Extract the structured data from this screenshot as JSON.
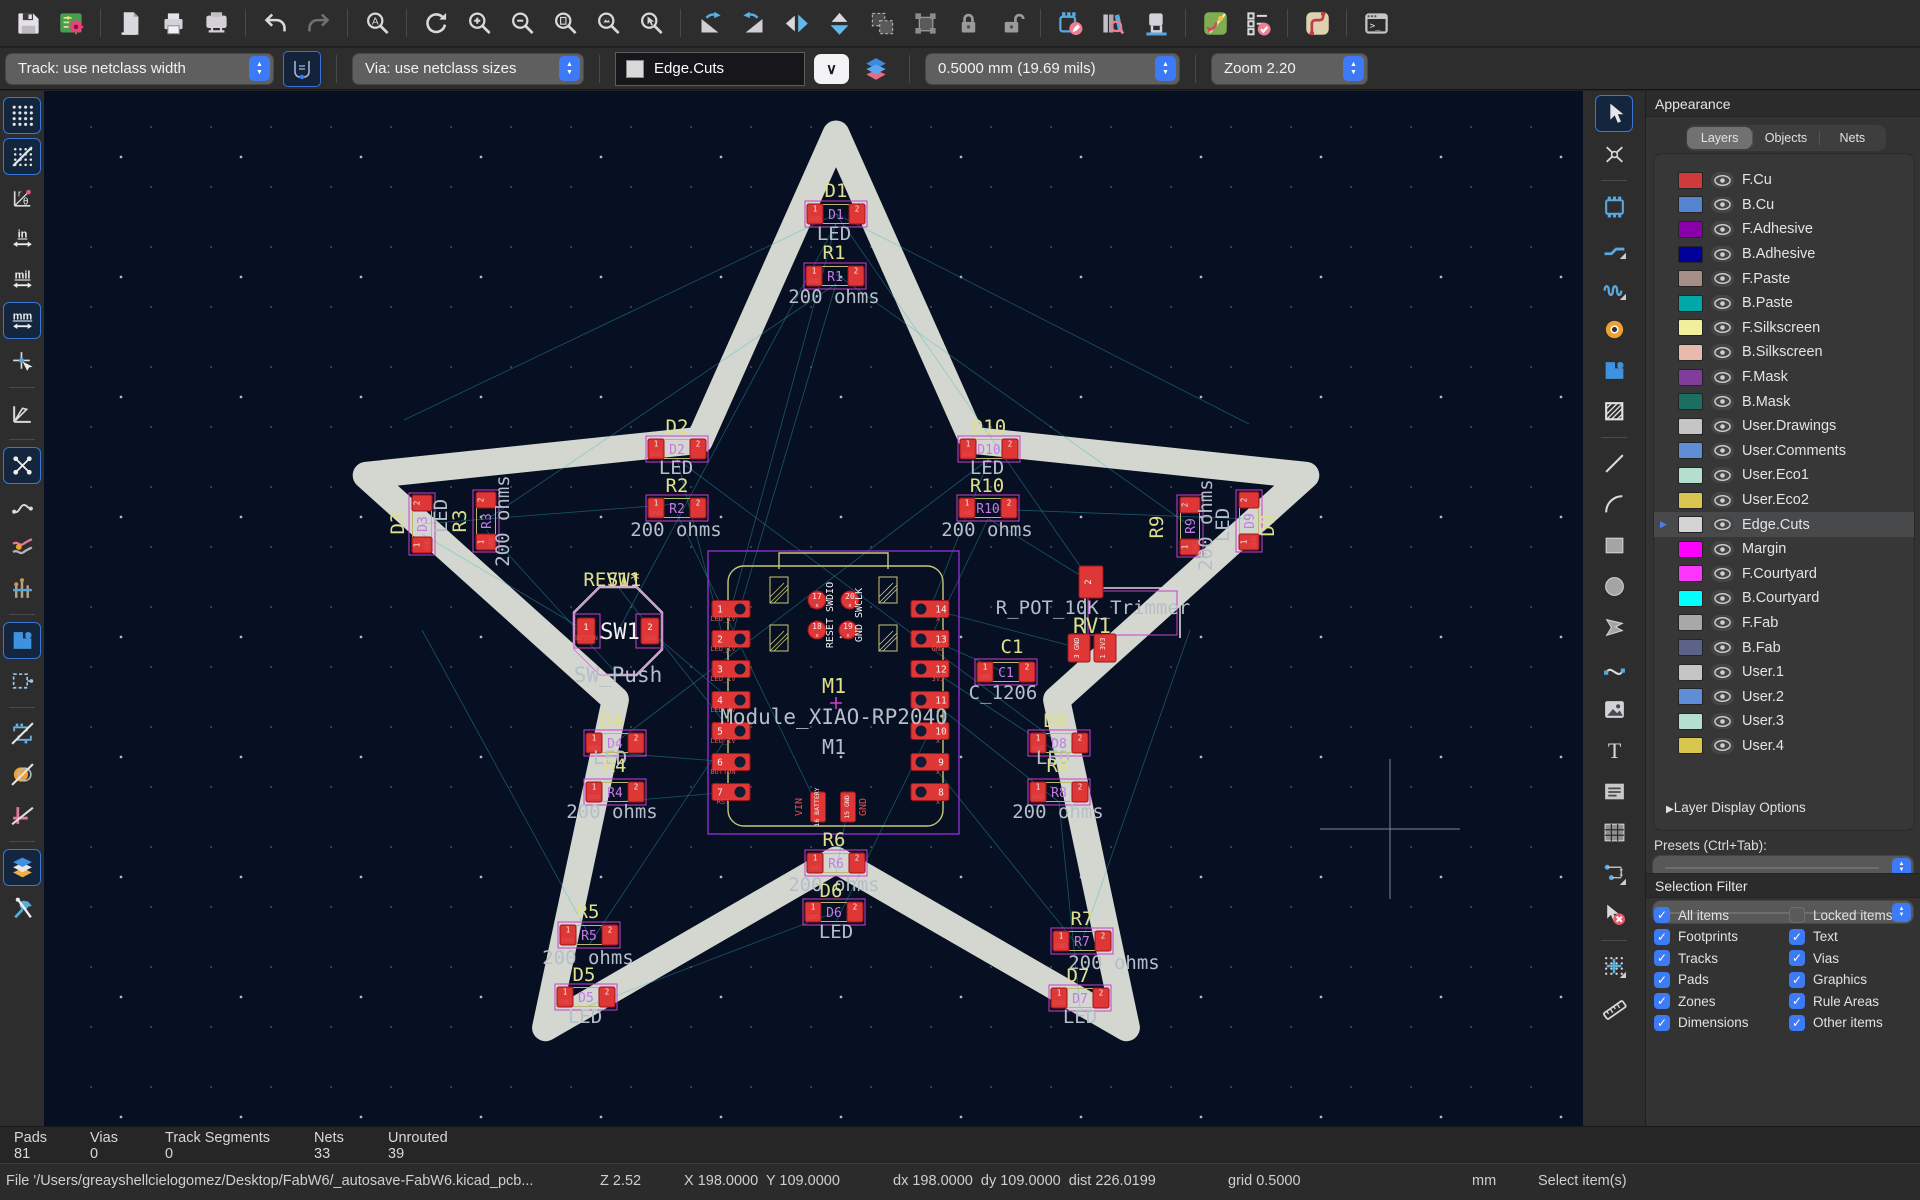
{
  "toolbar_top": {
    "items": [
      {
        "n": "save"
      },
      {
        "n": "board-setup"
      },
      {
        "n": "sep"
      },
      {
        "n": "page-settings"
      },
      {
        "n": "print"
      },
      {
        "n": "plot"
      },
      {
        "n": "sep"
      },
      {
        "n": "undo"
      },
      {
        "n": "redo"
      },
      {
        "n": "sep"
      },
      {
        "n": "find"
      },
      {
        "n": "sep"
      },
      {
        "n": "refresh"
      },
      {
        "n": "zoom-in"
      },
      {
        "n": "zoom-out"
      },
      {
        "n": "zoom-fit-page"
      },
      {
        "n": "zoom-fit-objects"
      },
      {
        "n": "zoom-selection"
      },
      {
        "n": "sep"
      },
      {
        "n": "rotate-ccw"
      },
      {
        "n": "rotate-cw"
      },
      {
        "n": "flip-horizontal"
      },
      {
        "n": "flip-vertical"
      },
      {
        "n": "group"
      },
      {
        "n": "ungroup"
      },
      {
        "n": "lock"
      },
      {
        "n": "unlock"
      },
      {
        "n": "sep"
      },
      {
        "n": "footprint-editor"
      },
      {
        "n": "footprint-browser"
      },
      {
        "n": "threed-viewer"
      },
      {
        "n": "sep"
      },
      {
        "n": "update-pcb"
      },
      {
        "n": "drc"
      },
      {
        "n": "sep"
      },
      {
        "n": "net-inspector"
      },
      {
        "n": "sep"
      },
      {
        "n": "python-console"
      }
    ]
  },
  "toolbar_settings": {
    "track_combo": "Track: use netclass width",
    "via_combo": "Via: use netclass sizes",
    "layer_combo": "Edge.Cuts",
    "grid_combo": "0.5000 mm (19.69 mils)",
    "zoom_combo": "Zoom 2.20",
    "dropdown_chevron": "∨"
  },
  "left_toolbar": {
    "items": [
      {
        "n": "grid-visibility",
        "active": true
      },
      {
        "n": "grid-override",
        "active": true
      },
      {
        "n": "polar-coords"
      },
      {
        "n": "units-inches"
      },
      {
        "n": "units-mils"
      },
      {
        "n": "units-mm",
        "active": true
      },
      {
        "n": "cursor-shape"
      },
      {
        "n": "sep"
      },
      {
        "n": "constrain-45"
      },
      {
        "n": "sep"
      },
      {
        "n": "show-ratsnest",
        "active": true
      },
      {
        "n": "curved-ratsnest"
      },
      {
        "n": "highlight-nets"
      },
      {
        "n": "net-colors"
      },
      {
        "n": "sep"
      },
      {
        "n": "zone-filled",
        "active": true
      },
      {
        "n": "zone-outline"
      },
      {
        "n": "sep"
      },
      {
        "n": "sketch-footprints"
      },
      {
        "n": "sketch-pads"
      },
      {
        "n": "sketch-tracks"
      },
      {
        "n": "sep"
      },
      {
        "n": "high-contrast",
        "active": true
      },
      {
        "n": "properties-tools"
      }
    ]
  },
  "right_toolbar": {
    "items": [
      {
        "n": "select",
        "active": true
      },
      {
        "n": "local-ratsnest"
      },
      {
        "n": "sep"
      },
      {
        "n": "place-footprint"
      },
      {
        "n": "route-tracks"
      },
      {
        "n": "tune-length"
      },
      {
        "n": "place-via"
      },
      {
        "n": "draw-zone"
      },
      {
        "n": "rule-area"
      },
      {
        "n": "sep"
      },
      {
        "n": "draw-line"
      },
      {
        "n": "draw-arc"
      },
      {
        "n": "draw-rectangle"
      },
      {
        "n": "draw-circle"
      },
      {
        "n": "draw-polygon"
      },
      {
        "n": "draw-bezier"
      },
      {
        "n": "place-image"
      },
      {
        "n": "place-text"
      },
      {
        "n": "place-textbox"
      },
      {
        "n": "place-table"
      },
      {
        "n": "dimension"
      },
      {
        "n": "delete-tool"
      },
      {
        "n": "sep"
      },
      {
        "n": "grid-origin"
      },
      {
        "n": "measure"
      }
    ]
  },
  "appearance": {
    "title": "Appearance",
    "tabs": [
      "Layers",
      "Objects",
      "Nets"
    ],
    "active_tab": "Layers",
    "layers": [
      {
        "name": "F.Cu",
        "color": "#d03a3a"
      },
      {
        "name": "B.Cu",
        "color": "#5585d0"
      },
      {
        "name": "F.Adhesive",
        "color": "#8a00a8"
      },
      {
        "name": "B.Adhesive",
        "color": "#00009b"
      },
      {
        "name": "F.Paste",
        "color": "#a58d88"
      },
      {
        "name": "B.Paste",
        "color": "#00a8a8"
      },
      {
        "name": "F.Silkscreen",
        "color": "#f2ef9c"
      },
      {
        "name": "B.Silkscreen",
        "color": "#e9b9ad"
      },
      {
        "name": "F.Mask",
        "color": "#803d9b"
      },
      {
        "name": "B.Mask",
        "color": "#1d6e62"
      },
      {
        "name": "User.Drawings",
        "color": "#c5c5c5"
      },
      {
        "name": "User.Comments",
        "color": "#5f8ed6"
      },
      {
        "name": "User.Eco1",
        "color": "#b5decf"
      },
      {
        "name": "User.Eco2",
        "color": "#d9c64e"
      },
      {
        "name": "Edge.Cuts",
        "color": "#d4d4d4",
        "selected": true
      },
      {
        "name": "Margin",
        "color": "#ff00ff"
      },
      {
        "name": "F.Courtyard",
        "color": "#fc36fc"
      },
      {
        "name": "B.Courtyard",
        "color": "#00ffff"
      },
      {
        "name": "F.Fab",
        "color": "#a8a8a8"
      },
      {
        "name": "B.Fab",
        "color": "#5c6387"
      },
      {
        "name": "User.1",
        "color": "#c5c5c5"
      },
      {
        "name": "User.2",
        "color": "#5f8ed6"
      },
      {
        "name": "User.3",
        "color": "#b5decf"
      },
      {
        "name": "User.4",
        "color": "#d9c64e"
      }
    ],
    "layer_display_options": "Layer Display Options",
    "presets_label": "Presets (Ctrl+Tab):",
    "viewports_label": "Viewports (Option+Tab):"
  },
  "selection_filter": {
    "title": "Selection Filter",
    "items": [
      {
        "label": "All items",
        "checked": true
      },
      {
        "label": "Locked items",
        "checked": false
      },
      {
        "label": "Footprints",
        "checked": true
      },
      {
        "label": "Text",
        "checked": true
      },
      {
        "label": "Tracks",
        "checked": true
      },
      {
        "label": "Vias",
        "checked": true
      },
      {
        "label": "Pads",
        "checked": true
      },
      {
        "label": "Graphics",
        "checked": true
      },
      {
        "label": "Zones",
        "checked": true
      },
      {
        "label": "Rule Areas",
        "checked": true
      },
      {
        "label": "Dimensions",
        "checked": true
      },
      {
        "label": "Other items",
        "checked": true
      }
    ]
  },
  "stats": {
    "pads_label": "Pads",
    "pads": "81",
    "vias_label": "Vias",
    "vias": "0",
    "track_segments_label": "Track Segments",
    "track_segments": "0",
    "nets_label": "Nets",
    "nets": "33",
    "unrouted_label": "Unrouted",
    "unrouted": "39"
  },
  "status_bar": {
    "file": "File '/Users/greayshellcielogomez/Desktop/FabW6/_autosave-FabW6.kicad_pcb...",
    "zoom": "Z 2.52",
    "xy": "X 198.0000  Y 109.0000",
    "dxdy": "dx 198.0000  dy 109.0000  dist 226.0199",
    "grid": "grid 0.5000",
    "units": "mm",
    "mode": "Select item(s)"
  },
  "pcb": {
    "star": {
      "cx": 836,
      "cy": 628,
      "outer_r": 494,
      "inner_r": 232,
      "stroke": "#d3d7cf",
      "width": 27
    },
    "cursor_cross": {
      "x": 1390,
      "y": 829
    },
    "footprints": [
      {
        "ref": "D1",
        "x": 836,
        "y": 214
      },
      {
        "ref": "R1",
        "x": 835,
        "y": 276
      },
      {
        "ref": "D2",
        "x": 677,
        "y": 449
      },
      {
        "ref": "R2",
        "x": 677,
        "y": 508
      },
      {
        "ref": "D10",
        "x": 989,
        "y": 449
      },
      {
        "ref": "R10",
        "x": 988,
        "y": 508
      },
      {
        "ref": "D3",
        "x": 422,
        "y": 524,
        "vert": true
      },
      {
        "ref": "R3",
        "x": 486,
        "y": 521,
        "vert": true
      },
      {
        "ref": "R9",
        "x": 1190,
        "y": 526,
        "vert": true
      },
      {
        "ref": "D9",
        "x": 1249,
        "y": 521,
        "vert": true
      },
      {
        "ref": "D4",
        "x": 615,
        "y": 743
      },
      {
        "ref": "R4",
        "x": 615,
        "y": 792
      },
      {
        "ref": "D8",
        "x": 1059,
        "y": 743
      },
      {
        "ref": "R8",
        "x": 1059,
        "y": 792
      },
      {
        "ref": "R6",
        "x": 836,
        "y": 863
      },
      {
        "ref": "D6",
        "x": 834,
        "y": 912
      },
      {
        "ref": "R5",
        "x": 589,
        "y": 935
      },
      {
        "ref": "D5",
        "x": 586,
        "y": 997
      },
      {
        "ref": "R7",
        "x": 1082,
        "y": 941
      },
      {
        "ref": "D7",
        "x": 1080,
        "y": 998
      },
      {
        "ref": "C1",
        "x": 1006,
        "y": 672
      }
    ],
    "texts": [
      [
        836,
        197,
        "D1",
        "y"
      ],
      [
        834,
        240,
        "LED",
        "g"
      ],
      [
        834,
        259,
        "R1",
        "y"
      ],
      [
        834,
        303,
        "200 ohms",
        "g"
      ],
      [
        677,
        433,
        "D2",
        "y"
      ],
      [
        676,
        474,
        "LED",
        "g"
      ],
      [
        677,
        492,
        "R2",
        "y"
      ],
      [
        676,
        536,
        "200 ohms",
        "g"
      ],
      [
        989,
        433,
        "D10",
        "y"
      ],
      [
        987,
        474,
        "LED",
        "g"
      ],
      [
        987,
        492,
        "R10",
        "y"
      ],
      [
        987,
        536,
        "200 ohms",
        "g"
      ],
      [
        404,
        523,
        "D3",
        "y",
        -90
      ],
      [
        447,
        516,
        "LED",
        "g",
        -90
      ],
      [
        466,
        521,
        "R3",
        "y",
        -90
      ],
      [
        509,
        521,
        "200 ohms",
        "g",
        -90
      ],
      [
        1163,
        527,
        "R9",
        "y",
        -90
      ],
      [
        1212,
        525,
        "200 ohms",
        "g",
        -90
      ],
      [
        1229,
        525,
        "LED",
        "g",
        -90
      ],
      [
        1274,
        525,
        "D9",
        "y",
        -90
      ],
      [
        612,
        586,
        "REV1*",
        "y"
      ],
      [
        624,
        586,
        "SW1",
        "y"
      ],
      [
        620,
        639,
        "SW1",
        "w",
        0,
        22
      ],
      [
        618,
        682,
        "SW_Push",
        "g",
        0,
        21
      ],
      [
        1093,
        614,
        "R_POT_10K_Trimmer",
        "g"
      ],
      [
        1092,
        633,
        "RV1",
        "y",
        0,
        21
      ],
      [
        1012,
        653,
        "C1",
        "y"
      ],
      [
        1003,
        699,
        "C_1206",
        "g"
      ],
      [
        612,
        727,
        "D4",
        "y"
      ],
      [
        610,
        764,
        "LED",
        "g"
      ],
      [
        615,
        772,
        "R4",
        "y"
      ],
      [
        612,
        818,
        "200 ohms",
        "g"
      ],
      [
        1055,
        727,
        "D8",
        "y"
      ],
      [
        1053,
        764,
        "LED",
        "g"
      ],
      [
        1058,
        772,
        "R8",
        "y"
      ],
      [
        1058,
        818,
        "200 ohms",
        "g"
      ],
      [
        834,
        846,
        "R6",
        "y"
      ],
      [
        834,
        891,
        "200 ohms",
        "g"
      ],
      [
        831,
        897,
        "D6",
        "y"
      ],
      [
        836,
        938,
        "LED",
        "g"
      ],
      [
        588,
        918,
        "R5",
        "y"
      ],
      [
        588,
        964,
        "200 ohms",
        "g"
      ],
      [
        584,
        981,
        "D5",
        "y"
      ],
      [
        585,
        1023,
        "LED",
        "g"
      ],
      [
        1082,
        925,
        "R7",
        "y"
      ],
      [
        1114,
        969,
        "200 ohms",
        "g"
      ],
      [
        1078,
        982,
        "D7",
        "y"
      ],
      [
        1080,
        1023,
        "LED",
        "g"
      ],
      [
        834,
        693,
        "M1",
        "y",
        0,
        20
      ],
      [
        834,
        724,
        "Module_XIAO-RP2040",
        "g",
        0,
        21
      ],
      [
        834,
        754,
        "M1",
        "g",
        0,
        20
      ]
    ],
    "module": {
      "frame": [
        708,
        551,
        251,
        283
      ],
      "body": [
        728,
        566,
        215,
        260
      ],
      "usb": [
        779,
        553,
        109,
        16
      ],
      "hatch": [
        [
          770,
          577
        ],
        [
          879,
          577
        ],
        [
          770,
          625
        ],
        [
          879,
          625
        ]
      ],
      "pin_y": [
        609,
        639,
        669,
        700,
        731,
        762,
        792
      ],
      "left_x": 731,
      "right_x": 930,
      "left_pins": [
        "1",
        "2",
        "3",
        "4",
        "5",
        "6",
        "7"
      ],
      "left_labels": [
        "LED_1V",
        "LED_1V",
        "LED_1V",
        "LED_1V",
        "LED_1V",
        "BUTTON",
        "RST"
      ],
      "right_pins": [
        "14",
        "13",
        "12",
        "11",
        "10",
        "9",
        "8"
      ],
      "right_labels": [
        "x",
        "GND",
        "3V3",
        "x",
        "x",
        "x",
        "x"
      ],
      "top_pins": [
        {
          "n": "17",
          "x": 817,
          "y": 600
        },
        {
          "n": "20",
          "x": 850,
          "y": 600
        },
        {
          "n": "18",
          "x": 817,
          "y": 630
        },
        {
          "n": "19",
          "x": 848,
          "y": 630
        }
      ],
      "top_labels": [
        {
          "x": 833,
          "y": 615,
          "s": "RESET SWDIO"
        },
        {
          "x": 862,
          "y": 615,
          "s": "GND SWCLK"
        }
      ],
      "bottom_pads": [
        {
          "x": 818,
          "y": 807,
          "s": "16 BATTERY"
        },
        {
          "x": 848,
          "y": 807,
          "s": "15 GND"
        }
      ],
      "bottom_labels": [
        {
          "x": 802,
          "y": 807,
          "s": "VIN"
        },
        {
          "x": 866,
          "y": 807,
          "s": "GND"
        }
      ]
    },
    "switch": {
      "cx": 618,
      "cy": 631,
      "r": 44,
      "pad1": "1",
      "pad1_label": "BUTTON",
      "pad2": "2",
      "pad2_label": "GND"
    },
    "trimmer": {
      "box": [
        1085,
        588,
        95,
        50
      ],
      "top_pad": {
        "x": 1091,
        "y": 582,
        "s": "2"
      },
      "pads": [
        {
          "x": 1079,
          "y": 648,
          "s": "3 GND"
        },
        {
          "x": 1105,
          "y": 648,
          "s": "1 3V3"
        }
      ]
    },
    "ratsnest": [
      [
        836,
        224,
        731,
        609
      ],
      [
        836,
        284,
        731,
        639
      ],
      [
        677,
        459,
        731,
        669
      ],
      [
        677,
        514,
        818,
        807
      ],
      [
        989,
        459,
        930,
        609
      ],
      [
        988,
        519,
        930,
        639
      ],
      [
        422,
        534,
        586,
        631
      ],
      [
        486,
        530,
        618,
        675
      ],
      [
        404,
        420,
        836,
        214
      ],
      [
        1249,
        424,
        836,
        214
      ],
      [
        422,
        630,
        589,
        935
      ],
      [
        1190,
        630,
        1082,
        941
      ],
      [
        650,
        631,
        731,
        700
      ],
      [
        618,
        587,
        731,
        731
      ],
      [
        615,
        753,
        731,
        762
      ],
      [
        615,
        802,
        731,
        792
      ],
      [
        1059,
        753,
        930,
        669
      ],
      [
        1059,
        802,
        930,
        700
      ],
      [
        836,
        873,
        848,
        807
      ],
      [
        836,
        922,
        930,
        731
      ],
      [
        589,
        945,
        731,
        731
      ],
      [
        586,
        1007,
        836,
        912
      ],
      [
        1082,
        951,
        930,
        762
      ],
      [
        1080,
        1008,
        1059,
        802
      ],
      [
        1004,
        672,
        930,
        639
      ],
      [
        1091,
        582,
        989,
        519
      ],
      [
        1079,
        648,
        930,
        609
      ],
      [
        836,
        284,
        486,
        520
      ],
      [
        836,
        274,
        1190,
        526
      ],
      [
        677,
        504,
        422,
        524
      ],
      [
        989,
        509,
        1249,
        519
      ],
      [
        677,
        459,
        1059,
        743
      ],
      [
        989,
        459,
        615,
        743
      ],
      [
        836,
        224,
        618,
        631
      ],
      [
        836,
        214,
        1091,
        582
      ]
    ]
  }
}
